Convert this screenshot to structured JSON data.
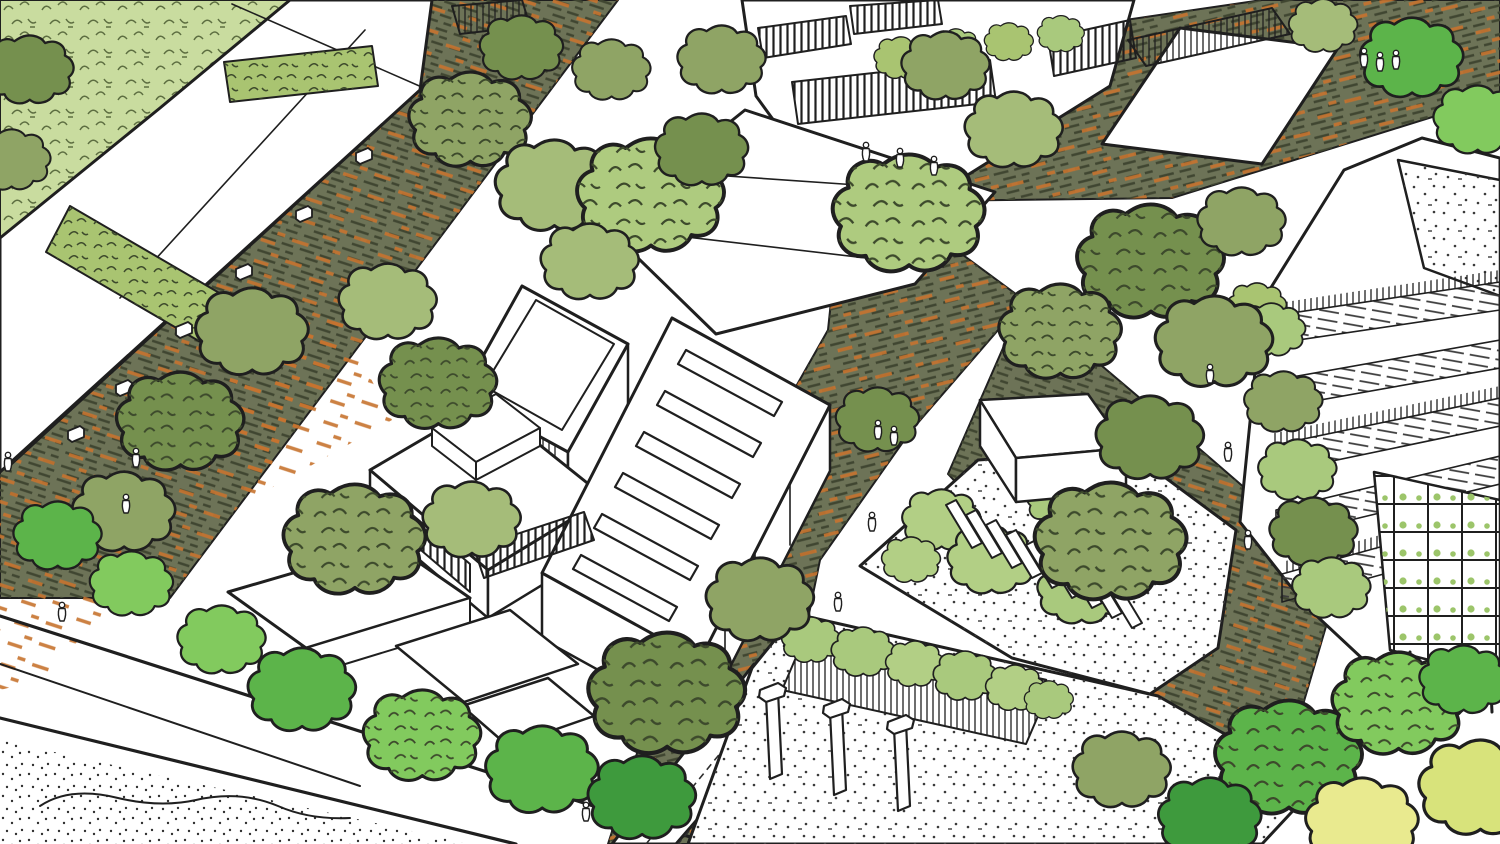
{
  "canvas": {
    "width": 1500,
    "height": 844
  },
  "colors": {
    "ink": "#1f1f1f",
    "paper": "#ffffff",
    "street_base": "#6d7357",
    "street_dash": "#404631",
    "street_orange": "#c7742f",
    "lawn": "#c9dc9f",
    "lawn_stroke": "#5d6e41",
    "green_roof": "#a9c471",
    "vine": "#a9c97d",
    "shrub_light": "#b2cf85",
    "tree_sage": "#8fa465",
    "tree_sage_dark": "#75904e",
    "tree_sage_light": "#a5bc79",
    "tree_pale": "#aecb7f",
    "tree_bright": "#5cb44a",
    "tree_bright_light": "#82ca5e",
    "tree_bright_dark": "#3e9a3d",
    "tree_yellow": "#d8e37b",
    "tree_yellow_light": "#e9ea8f",
    "stipple_dot": "#3a3a3a",
    "hatch_dash": "#3b3b3b",
    "trellis_green": "#9cc56a",
    "gravel_dot": "#303030"
  },
  "scene": {
    "style": "hand-drawn pen-and-ink aerial axonometric masterplan sketch with watercolor greens",
    "elements": [
      {
        "name": "lawn-top-left",
        "kind": "lawn"
      },
      {
        "name": "industrial-shed-with-green-roof-strips",
        "kind": "building",
        "green_roof_strips": 2,
        "rooftop_vents": 6
      },
      {
        "name": "tree-lined-street",
        "kind": "street",
        "paving": "olive and orange brick hatch"
      },
      {
        "name": "upper-plaza",
        "kind": "street"
      },
      {
        "name": "central-street",
        "kind": "street"
      },
      {
        "name": "terraced-housing-with-striped-railings",
        "kind": "building",
        "railing_bands": 4
      },
      {
        "name": "plaza-edge-hall",
        "kind": "building"
      },
      {
        "name": "flat-roof-factory",
        "kind": "building"
      },
      {
        "name": "courtyard-parapet-building",
        "kind": "building"
      },
      {
        "name": "studio-with-louvre-band",
        "kind": "building"
      },
      {
        "name": "sawtooth-roof-workshop",
        "kind": "building",
        "skylight_rows": 6
      },
      {
        "name": "fin-roof-garden-pavilion",
        "kind": "building",
        "roof_fins": 9
      },
      {
        "name": "assembly-hall-with-chimneys",
        "kind": "building",
        "chimneys": 3,
        "clerestory": "vine-covered louvre monitor"
      },
      {
        "name": "planted-terrace-tower-with-trellis",
        "kind": "building",
        "terrace_bands": 5,
        "trellis_facade": true
      },
      {
        "name": "low-garden-pavilions",
        "kind": "building",
        "count": 3
      },
      {
        "name": "boulevard-road",
        "kind": "road",
        "edge_lines": "double ink"
      },
      {
        "name": "gravel-verge",
        "kind": "ground",
        "texture": "stipple"
      },
      {
        "name": "street-tree-canopies",
        "kind": "vegetation",
        "count": 39
      },
      {
        "name": "hedgerows",
        "kind": "vegetation",
        "count": 7
      },
      {
        "name": "pedestrians",
        "kind": "people",
        "count": 18
      }
    ]
  }
}
